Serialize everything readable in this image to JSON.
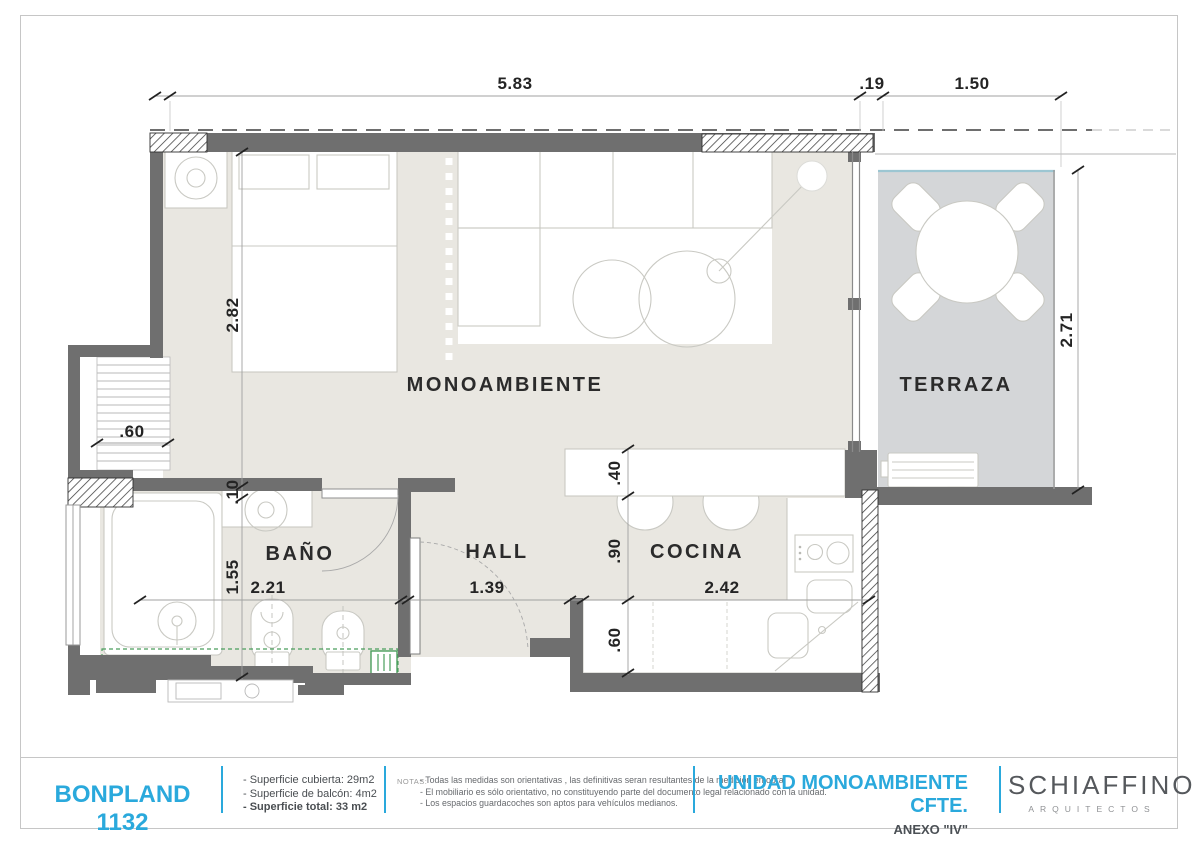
{
  "plan": {
    "room_labels": {
      "monoambiente": "MONOAMBIENTE",
      "terraza": "TERRAZA",
      "bano": "BAÑO",
      "hall": "HALL",
      "cocina": "COCINA"
    },
    "dims": {
      "top_total": "5.83",
      "top_wall": ".19",
      "top_terrace": "1.50",
      "room_height": "2.82",
      "ledge": ".60",
      "wall": ".10",
      "bath_height": "1.55",
      "bath_width": "2.21",
      "hall_width": "1.39",
      "kitchen_width": "2.42",
      "island_depth": ".40",
      "kitchen_depth": ".90",
      "kitchen_lower": ".60",
      "terrace_height": "2.71"
    }
  },
  "footer": {
    "project": "BONPLAND 1132",
    "areas": [
      "- Superficie cubierta:  29m2",
      "- Superficie de balcón: 4m2",
      "- Superficie total: 33 m2"
    ],
    "notes_label": "NOTAS:",
    "notes": [
      "- Todas las medidas son orientativas , las definitivas seran resultantes de la medición en obra.",
      "- El mobiliario es sólo orientativo, no constituyendo parte del documento legal relacionado con la unidad.",
      "- Los espacios guardacoches son aptos para vehículos medianos."
    ],
    "unit_title": "UNIDAD MONOAMBIENTE CFTE.",
    "annex": "ANEXO \"IV\"",
    "studio_name": "SCHIAFFINO",
    "studio_subtitle": "ARQUITECTOS"
  },
  "colors": {
    "accent_blue": "#2aa9dc",
    "wall_gray": "#6f6f6f",
    "floor_beige": "#e9e7e1",
    "terrace_gray": "#d4d6d8",
    "symbol_green": "#4a9e5c"
  }
}
